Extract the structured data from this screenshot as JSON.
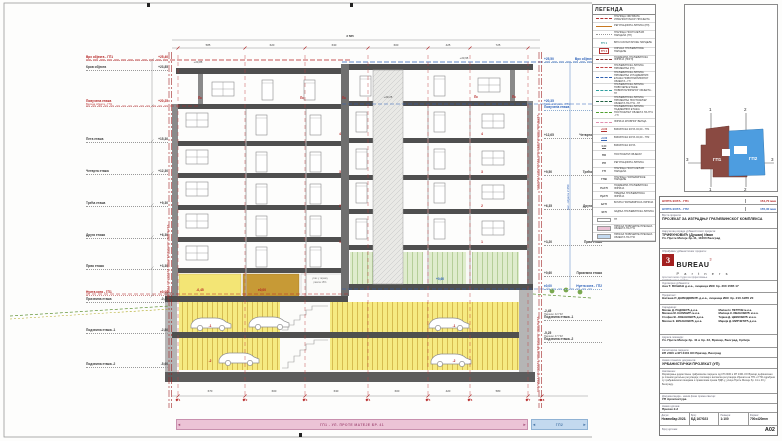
{
  "sheet": {
    "boundary_label": "ГРАНИЦА ОБУХВАТА УРБАНИСТИЧКОГ ПРОЈЕКТА",
    "height_dim_right": "вис. објекта 2 650",
    "bands": {
      "gp1": "ГП1 - УЛ. ПРОТЕ МАТЕЈЕ БР. 41",
      "gp2": "ГП2",
      "arrow_left": "◄",
      "arrow_right": "►"
    }
  },
  "colors": {
    "red": "#b42222",
    "blue": "#2a5fb8",
    "orange": "#c87820",
    "yellow": "#f6ea82",
    "ochre": "#c79a36",
    "green": "#dfeccd",
    "pink_band": "#ecc3d6",
    "blue_band": "#c3d9ef"
  },
  "floors_left": [
    {
      "label": "Врх објекта - ГП1",
      "elev": "+25,40",
      "y": 56,
      "cls": "red"
    },
    {
      "label": "Кров објекта",
      "elev": "+23,85",
      "y": 66
    },
    {
      "label": "Повучена етажа",
      "sub": "Висина објекта - ГП1",
      "elev": "+20,25",
      "y": 100,
      "cls": "red"
    },
    {
      "label": "Пета етажа",
      "elev": "+15,30",
      "y": 138
    },
    {
      "label": "Четврта етажа",
      "elev": "+12,30",
      "y": 170
    },
    {
      "label": "Трећа етажа",
      "elev": "+9,30",
      "y": 202
    },
    {
      "label": "Друга етажа",
      "elev": "+6,30",
      "y": 234
    },
    {
      "label": "Прва етажа",
      "elev": "+3,30",
      "y": 265
    },
    {
      "label": "Нулта кота - ГП1",
      "elev": "±0,00",
      "y": 291,
      "cls": "red"
    },
    {
      "label": "Приземна етажа",
      "elev": "-0,45",
      "y": 298
    },
    {
      "label": "Подземна етажа -1",
      "elev": "-2,80",
      "y": 329
    },
    {
      "label": "Подземна етажа -2",
      "elev": "-5,60",
      "y": 363
    }
  ],
  "floors_right": [
    {
      "label": "Врх објекта - ГП2",
      "elev": "+25,50",
      "y": 58,
      "cls": "blue"
    },
    {
      "label": "Повучена етажа",
      "sub": "Висина објекта - ГП2",
      "elev": "+20,35",
      "y": 100,
      "cls": "blue"
    },
    {
      "label": "Четврта етажа",
      "elev": "+12,65",
      "y": 134
    },
    {
      "label": "Трећа етажа",
      "elev": "+9,50",
      "y": 171
    },
    {
      "label": "Друга етажа",
      "elev": "+6,35",
      "y": 205
    },
    {
      "label": "Прва етажа",
      "elev": "+3,20",
      "y": 241
    },
    {
      "label": "Приземна етажа",
      "elev": "+0,60",
      "y": 272
    },
    {
      "label": "Нулта кота - ГП2",
      "elev": "±0,00",
      "y": 285,
      "cls": "blue"
    },
    {
      "label": "Подземна етажа -1",
      "sub": "Паркинг 42 ПМ",
      "elev": "-2,45",
      "y": 310
    },
    {
      "label": "Подземна етажа -2",
      "sub": "Паркинг 47 ПМ",
      "elev": "-5,25",
      "y": 332
    }
  ],
  "marks": [
    {
      "x": 200,
      "y": 96,
      "label": "Пс",
      "cls": "red"
    },
    {
      "x": 302,
      "y": 96,
      "label": "Пс",
      "cls": "red"
    },
    {
      "x": 344,
      "y": 96,
      "label": "Пс",
      "cls": "red"
    },
    {
      "x": 476,
      "y": 95,
      "label": "Пс",
      "cls": "red"
    },
    {
      "x": 514,
      "y": 95,
      "label": "Пс",
      "cls": "red"
    },
    {
      "x": 340,
      "y": 132,
      "label": "4",
      "cls": "red"
    },
    {
      "x": 482,
      "y": 132,
      "label": "4",
      "cls": "red"
    },
    {
      "x": 340,
      "y": 170,
      "label": "3",
      "cls": "red"
    },
    {
      "x": 482,
      "y": 170,
      "label": "3",
      "cls": "red"
    },
    {
      "x": 340,
      "y": 204,
      "label": "2",
      "cls": "red"
    },
    {
      "x": 482,
      "y": 204,
      "label": "2",
      "cls": "red"
    },
    {
      "x": 340,
      "y": 240,
      "label": "1",
      "cls": "red"
    },
    {
      "x": 482,
      "y": 240,
      "label": "1",
      "cls": "red"
    },
    {
      "x": 210,
      "y": 324,
      "label": "-1",
      "cls": "red"
    },
    {
      "x": 454,
      "y": 324,
      "label": "-1",
      "cls": "red"
    },
    {
      "x": 210,
      "y": 359,
      "label": "-2",
      "cls": "red"
    },
    {
      "x": 454,
      "y": 359,
      "label": "-2",
      "cls": "red"
    },
    {
      "x": 200,
      "y": 288,
      "label": "-0,45",
      "cls": "red"
    },
    {
      "x": 262,
      "y": 288,
      "label": "±0,00",
      "cls": "red"
    },
    {
      "x": 320,
      "y": 277,
      "label": "улаз у гаражу",
      "cls": "tiny"
    },
    {
      "x": 320,
      "y": 281,
      "label": "рампа 15%",
      "cls": "tiny"
    },
    {
      "x": 198,
      "y": 60,
      "label": "+23,85",
      "cls": "dark"
    },
    {
      "x": 464,
      "y": 56,
      "label": "+23,95",
      "cls": "dark"
    },
    {
      "x": 388,
      "y": 95,
      "label": "+20,25",
      "cls": "dark"
    },
    {
      "x": 440,
      "y": 277,
      "label": "+0,60",
      "cls": "blue"
    }
  ],
  "dims_top": [
    {
      "x": 208,
      "label": "585"
    },
    {
      "x": 272,
      "label": "620"
    },
    {
      "x": 334,
      "label": "630"
    },
    {
      "x": 396,
      "label": "600"
    },
    {
      "x": 448,
      "label": "425"
    },
    {
      "x": 498,
      "label": "725"
    }
  ],
  "dims_total": {
    "label": "3 585"
  },
  "dims_bottom": [
    {
      "x": 210,
      "label": "670"
    },
    {
      "x": 274,
      "label": "600"
    },
    {
      "x": 336,
      "label": "630"
    },
    {
      "x": 397,
      "label": "600"
    },
    {
      "x": 448,
      "label": "420"
    },
    {
      "x": 498,
      "label": "580"
    }
  ],
  "axes": [
    {
      "x": 178,
      "label": "1"
    },
    {
      "x": 245,
      "label": "2"
    },
    {
      "x": 305,
      "label": "3"
    },
    {
      "x": 368,
      "label": "4"
    },
    {
      "x": 428,
      "label": "5"
    },
    {
      "x": 470,
      "label": "6"
    },
    {
      "x": 528,
      "label": "7"
    },
    {
      "x": 542,
      "label": "8"
    }
  ],
  "legend": {
    "title": "ЛЕГЕНДА",
    "items": [
      {
        "t": "line",
        "d": "dashdot",
        "c": "#b03030",
        "label": "Граница обухвата урбанистичког пројекта"
      },
      {
        "t": "line",
        "d": "solid",
        "c": "#c87820",
        "label": "Регулациона линија (РЛ)"
      },
      {
        "t": "line",
        "d": "dotted",
        "c": "#999999",
        "label": "Граница постојећих парцела (ГП)"
      },
      {
        "t": "text",
        "c": "#2a9090",
        "sw": "ГП 1",
        "label": "Број катастарске парцеле"
      },
      {
        "t": "box-text",
        "c": "#b03030",
        "sw": "ГП 1",
        "label": "Ознака грађевинске парцеле"
      },
      {
        "t": "line",
        "d": "dashed",
        "c": "#803030",
        "label": "Подземна грађевинска линија (ПоГЛ)"
      },
      {
        "t": "line",
        "d": "dashed",
        "c": "#c04040",
        "label": "Грађевинска линија приземља (ГЛ)"
      },
      {
        "t": "line",
        "d": "dashed",
        "c": "#3060b0",
        "label": "Грађевинска линија приземља и надземних етажа новопланираног објекта - ГЛ"
      },
      {
        "t": "line",
        "d": "dashed",
        "c": "#30a0a0",
        "label": "Грађевинска линија повучене етаже новопланираног објекта - ГЛ"
      },
      {
        "t": "line",
        "d": "dashed",
        "c": "#206040",
        "label": "Грађевинска линија приземља постојећег објекта на ГП1 - ГЛ"
      },
      {
        "t": "line",
        "d": "dashed",
        "c": "#50a030",
        "label": "Грађевинска линија надземних етажа постојећег објекта на ГП1 - ГЛ"
      },
      {
        "t": "line",
        "d": "dashed",
        "c": "#e090b0",
        "label": "Линија кровног венца"
      },
      {
        "t": "flag",
        "c": "#b03030",
        "sw": "+0,00",
        "label": "Висинска кота ±0,00 - ГП1"
      },
      {
        "t": "flag",
        "c": "#3060b0",
        "sw": "+0,00",
        "label": "Висинска кота ±0,00 - ГП2"
      },
      {
        "t": "flag",
        "c": "#555555",
        "sw": "0,00",
        "label": "Висинска кота"
      },
      {
        "t": "text",
        "c": "#444444",
        "sw": "ПО",
        "label": "Постојећи објекат"
      },
      {
        "t": "text",
        "c": "#444444",
        "sw": "РЛ",
        "label": "Регулациона линија"
      },
      {
        "t": "text",
        "c": "#444444",
        "sw": "ГП",
        "label": "Граница постојећих парцела"
      },
      {
        "t": "text",
        "c": "#444444",
        "sw": "ГПВ",
        "label": "Граница грађевинске парцеле"
      },
      {
        "t": "text",
        "c": "#444444",
        "sw": "ПоГЛ",
        "label": "Подземна грађевинска линија"
      },
      {
        "t": "text",
        "c": "#444444",
        "sw": "ПрГЛ",
        "label": "Предња грађевинска линија"
      },
      {
        "t": "text",
        "c": "#444444",
        "sw": "БГЛ",
        "label": "Бочна грађевинска линија"
      },
      {
        "t": "text",
        "c": "#444444",
        "sw": "ЗГЛ",
        "label": "Задња грађевинска линија"
      },
      {
        "t": "box",
        "c": "#ffffff",
        "label": "ГП"
      },
      {
        "t": "box",
        "c": "#ecc3d6",
        "label": "Приказ површине пресека објекта на ГП1"
      },
      {
        "t": "box",
        "c": "#c3d9ef",
        "label": "Приказ површине пресека објекта на ГП2"
      }
    ]
  },
  "keyplan": {
    "gp1": "ГП1",
    "gp2": "ГП2",
    "s1": "1",
    "s2": "2",
    "s3": "3"
  },
  "titleblock": {
    "kota1_label": "НУЛТА КОТА - ГП1",
    "kota1_value": "154,70 мнв",
    "kota2_label": "НУЛТА КОТА - ГП2",
    "kota2_value": "155,30 мнв",
    "type_label": "Врста пројекта:",
    "type_value": "ПРОЈЕКАТ ЗА ИЗГРАДЊУ ГРАЂЕВИНСКОГ КОМПЛЕКСА",
    "client_label": "Наручилац израде урбанистичког пројекта:",
    "client_name": "ТРИФУНОВИЋ (Душан) Иван",
    "client_addr": "Ул. Проте Матеје бр.41, 11000 Београд",
    "firm_label": "Обрађивач урбанистичког пројекта:",
    "logo_num": "3",
    "logo_name": "BUREAU",
    "logo_sup": "3",
    "logo_sub": "P a r t n e r s",
    "firm_line1": "Архитектонски студио за пројектовање",
    "firm_line2": "11000 Београд, Србија",
    "resp_label": "Одговорни урбаниста:",
    "resp_value": "Ана Т. БОШАН д.и.а., лиценца ИКС бр. 200 1585 17",
    "proj_label": "Пројектант:",
    "proj_value": "Наташа Р. ДАВИДОВИЋ д.и.а., лиценца ИКС бр. 210 А955 20",
    "collab_label": "Сарадници:",
    "collaborators": [
      {
        "a": "Милан Д. РАДОВИЋ д.и.а.",
        "b": "Милан Н. ПЕТРОВ м.и.а."
      },
      {
        "a": "Милена М. КАЛИНИЋ м.и.а.",
        "b": "Милица К. ИВАНОВИЋ м.и.а."
      },
      {
        "a": "Стефан Ж. ЈОВАНОВИЋ д.и.а.",
        "b": "Тијана Д. ЦВИЈОВИЋ м.и.а."
      },
      {
        "a": "Милош К. ВУКАНОВИЋ д.и.а.",
        "b": "Марија Д. МИРЧЕТИЋ д.и.а."
      }
    ],
    "loc_label": "Адреса локације:",
    "loc_value": "Ул. Проте Матеје бр. 41 и бр. 43, Врачар, Београд, Србија",
    "parc_label": "Катастарске парцеле:",
    "parc_value": "КП 2400 и КП 2401 КО Врачар, Београд",
    "doc_label": "Назив планског документа:",
    "doc_value": "УРБАНИСТИЧКИ ПРОЈЕКАТ (УП)",
    "notes_label": "Напомена:",
    "notes": "Формирање јединствене грађевинске парцеле од КП 2400 и КП 2401 КО Врачар дефинисано је планом детаљне регулације; положај и висинска регулација објеката на ГП1 и ГП2 одређени су грађевинским линијама и правилима према ПДР-у, улица Проте Матеје бр. 41 и 43 у Београду.",
    "phase_label": "Документација - назив фазе према свесци:",
    "phase_value": "УП Архитектура",
    "drawing_label": "Назив цртежа:",
    "drawing_value": "Пресек 2-2",
    "date_label": "Датум:",
    "date_value": "Новембар 2023.",
    "num_label": "Број:",
    "num_value": "БД 167/023",
    "scale_label": "Размера:",
    "scale_value": "1:100",
    "format_label": "Формат:",
    "format_value": "700x420mm",
    "sheetno_label": "Број цртежа:",
    "sheetno_value": "А02"
  }
}
